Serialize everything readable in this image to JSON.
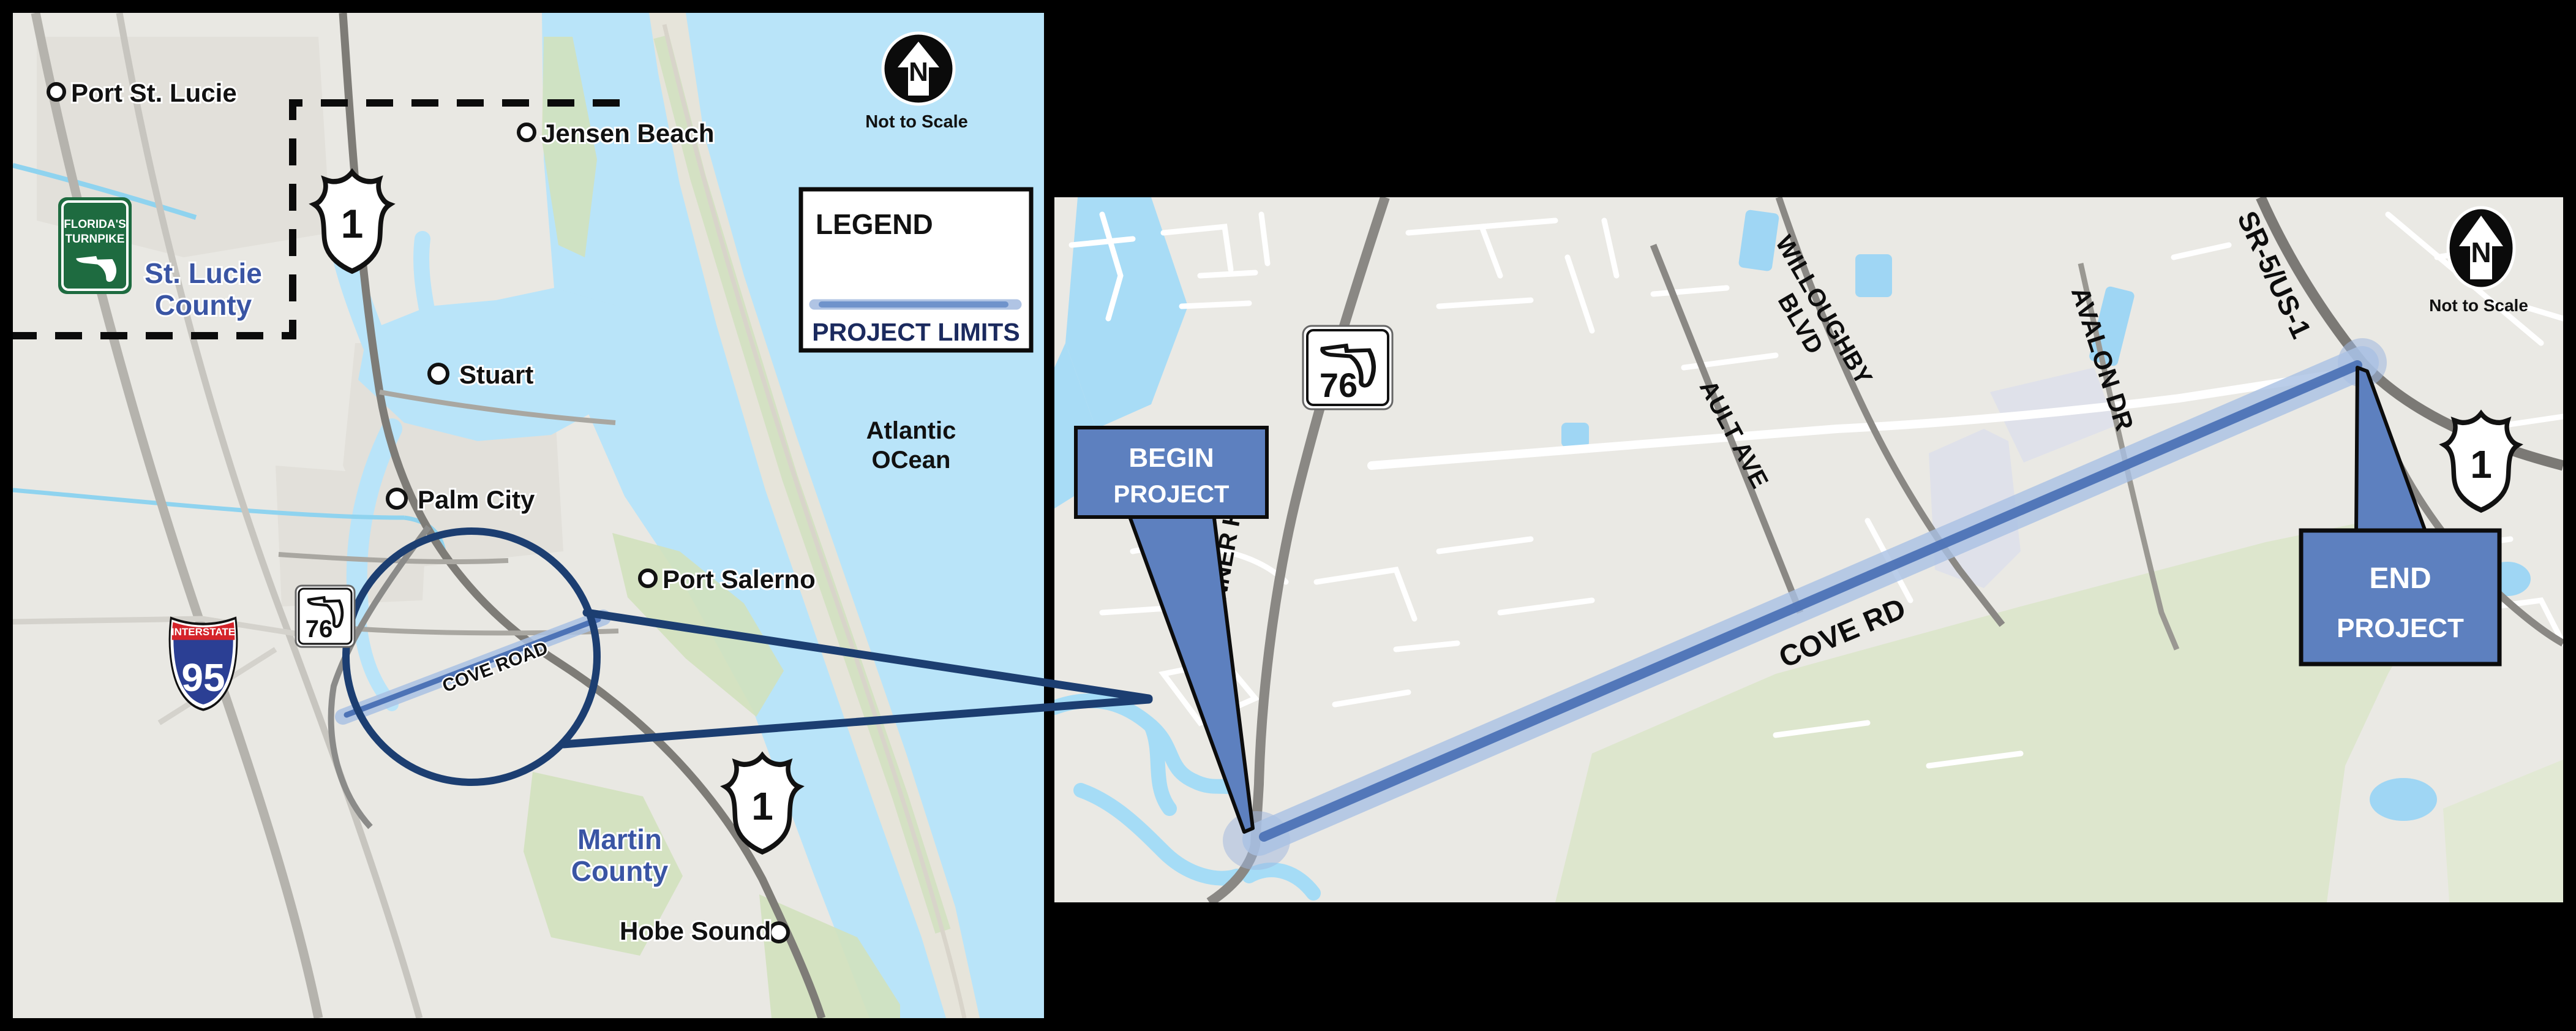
{
  "colors": {
    "background": "#000000",
    "land": "#e9e8e3",
    "water": "#b9e4f9",
    "green_area": "#d2e1bd",
    "callout_blue": "#5d80bf",
    "project_core_blue": "#4d73b6",
    "project_halo_blue": "#a9c1e3",
    "highlight_circle_navy": "#1c3e71",
    "county_label_blue": "#3a55a4",
    "legend_text_navy": "#1b2a5e",
    "turnpike_green": "#1e6b40",
    "interstate_blue": "#2b3f94",
    "interstate_red": "#d5232a"
  },
  "left": {
    "north_n": "N",
    "not_to_scale": "Not to Scale",
    "legend_title": "LEGEND",
    "legend_item": "PROJECT LIMITS",
    "ocean1": "Atlantic",
    "ocean2": "OCean",
    "county1a": "St. Lucie",
    "county1b": "County",
    "county2a": "Martin",
    "county2b": "County",
    "cities": {
      "port_st_lucie": "Port St. Lucie",
      "jensen_beach": "Jensen Beach",
      "stuart": "Stuart",
      "palm_city": "Palm City",
      "port_salerno": "Port Salerno",
      "hobe_sound": "Hobe Sound"
    },
    "cove_road": "COVE ROAD",
    "shield_us1": "1",
    "shield_i95": "95",
    "shield_interstate": "INTERSTATE",
    "shield_sr76": "76",
    "turnpike1": "FLORIDA'S",
    "turnpike2": "TURNPIKE"
  },
  "right": {
    "north_n": "N",
    "not_to_scale": "Not to Scale",
    "begin1": "BEGIN",
    "begin2": "PROJECT",
    "end1": "END",
    "end2": "PROJECT",
    "kanner": "KANNER HWY",
    "ault": "AULT AVE",
    "willoughby1": "WILLOUGHBY",
    "willoughby2": "BLVD",
    "avalon": "AVALON DR",
    "sr5": "SR-5/US-1",
    "cove_rd": "COVE RD",
    "shield_sr76": "76",
    "shield_us1": "1"
  }
}
